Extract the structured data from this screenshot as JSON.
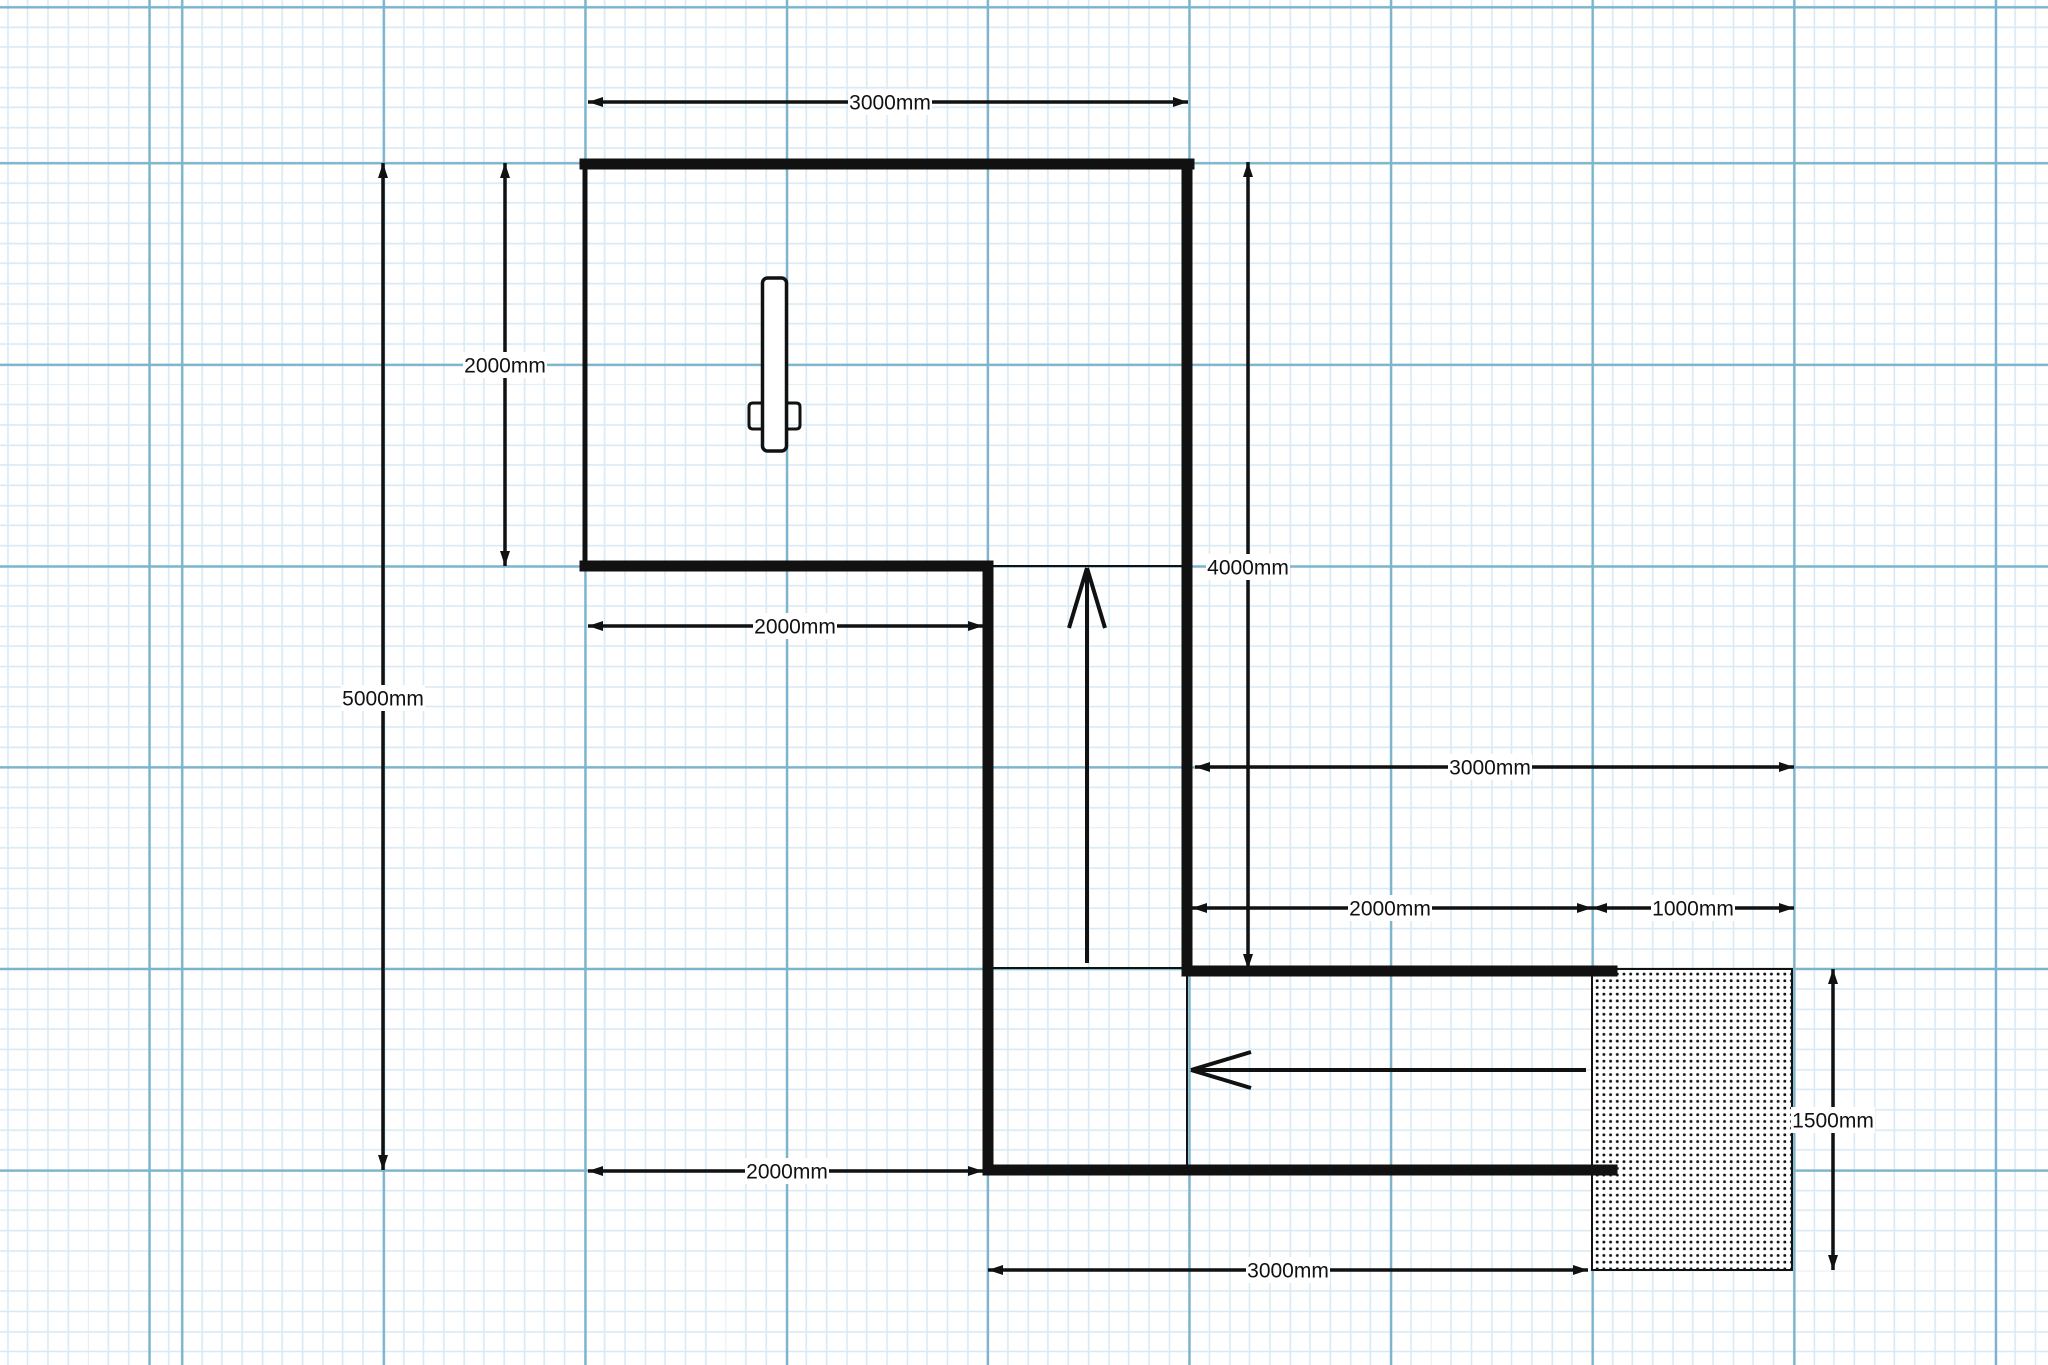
{
  "canvas": {
    "width": 2048,
    "height": 1365,
    "background": "#ffffff"
  },
  "grid": {
    "minor_spacing_px": 20.15,
    "major_spacing_px": 201.5,
    "minor_color": "#d9eaf5",
    "major_color": "#7db4cd",
    "minor_line_px": 1.6,
    "major_line_px": 2.4,
    "offset_x": 182,
    "offset_y": 163,
    "background": "#ffffff"
  },
  "style": {
    "ink_color": "#111111",
    "wall_thick_px": 11,
    "wall_thin_px": 5,
    "inner_line_px": 2,
    "dim_line_px": 3.5,
    "flow_line_px": 4,
    "dim_font_px": 21,
    "label_bg": "#ffffff",
    "label_chip_w": 84,
    "label_chip_h": 26,
    "dim_arrow_len": 15,
    "dim_arrow_half_w": 5,
    "flow_head_back": 60,
    "flow_head_half_w": 18,
    "hatch_dot_spacing": 6.7,
    "hatch_dot_size": 2.8
  },
  "plan": {
    "scale_note": "1000mm = 201.5px",
    "walls_thick": [
      {
        "name": "wall-room-top",
        "x1": 585,
        "y1": 164,
        "x2": 1189,
        "y2": 164
      },
      {
        "name": "wall-room-bottom",
        "x1": 585,
        "y1": 566,
        "x2": 988,
        "y2": 566
      },
      {
        "name": "wall-corridor-left",
        "x1": 988,
        "y1": 566,
        "x2": 988,
        "y2": 1170
      },
      {
        "name": "wall-right",
        "x1": 1187,
        "y1": 164,
        "x2": 1187,
        "y2": 971
      },
      {
        "name": "wall-corridor-top",
        "x1": 1187,
        "y1": 971,
        "x2": 1612,
        "y2": 971
      },
      {
        "name": "wall-corridor-bottom",
        "x1": 988,
        "y1": 1170,
        "x2": 1612,
        "y2": 1170
      }
    ],
    "walls_thin": [
      {
        "name": "wall-room-left",
        "x1": 585,
        "y1": 164,
        "x2": 585,
        "y2": 566
      }
    ],
    "inner_lines": [
      {
        "name": "opening-room-to-corridor",
        "x1": 988,
        "y1": 566,
        "x2": 1187,
        "y2": 566
      },
      {
        "name": "opening-corridor-bend-top",
        "x1": 988,
        "y1": 968,
        "x2": 1187,
        "y2": 968
      },
      {
        "name": "opening-corridor-bend-right",
        "x1": 1187,
        "y1": 976,
        "x2": 1187,
        "y2": 1165
      }
    ],
    "hatch": {
      "name": "hatched-area",
      "x": 1592,
      "y": 969,
      "w": 200,
      "h": 301
    },
    "door": {
      "name": "door-symbol",
      "leaf": {
        "x": 762.5,
        "y": 278,
        "w": 24,
        "h": 173,
        "rx": 5
      },
      "handle_left": "M 764 403 H 753 Q 749 403 749 407 V 425 Q 749 429 753 429 H 764",
      "handle_right": "M 785 403 H 796 Q 800 403 800 407 V 425 Q 800 429 796 429 H 785"
    },
    "dimensions": [
      {
        "name": "dim-top-3000",
        "x1": 588,
        "y1": 102,
        "x2": 1188,
        "y2": 102,
        "label": "3000mm",
        "lx": 890,
        "ly": 102
      },
      {
        "name": "dim-left-5000",
        "x1": 383,
        "y1": 163,
        "x2": 383,
        "y2": 1170,
        "label": "5000mm",
        "lx": 383,
        "ly": 698
      },
      {
        "name": "dim-left-2000",
        "x1": 505,
        "y1": 163,
        "x2": 505,
        "y2": 566,
        "label": "2000mm",
        "lx": 505,
        "ly": 365
      },
      {
        "name": "dim-mid-2000",
        "x1": 588,
        "y1": 626,
        "x2": 983,
        "y2": 626,
        "label": "2000mm",
        "lx": 795,
        "ly": 626
      },
      {
        "name": "dim-right-4000",
        "x1": 1248,
        "y1": 162,
        "x2": 1248,
        "y2": 969,
        "label": "4000mm",
        "lx": 1248,
        "ly": 567
      },
      {
        "name": "dim-right-3000",
        "x1": 1195,
        "y1": 767,
        "x2": 1794,
        "y2": 767,
        "label": "3000mm",
        "lx": 1490,
        "ly": 767
      },
      {
        "name": "dim-right-2000",
        "x1": 1192,
        "y1": 908,
        "x2": 1592,
        "y2": 908,
        "label": "2000mm",
        "lx": 1390,
        "ly": 908
      },
      {
        "name": "dim-right-1000",
        "x1": 1592,
        "y1": 908,
        "x2": 1794,
        "y2": 908,
        "label": "1000mm",
        "lx": 1693,
        "ly": 908
      },
      {
        "name": "dim-bottom-2000",
        "x1": 588,
        "y1": 1171,
        "x2": 983,
        "y2": 1171,
        "label": "2000mm",
        "lx": 787,
        "ly": 1171
      },
      {
        "name": "dim-bottom-3000",
        "x1": 988,
        "y1": 1270,
        "x2": 1588,
        "y2": 1270,
        "label": "3000mm",
        "lx": 1288,
        "ly": 1270
      },
      {
        "name": "dim-right-1500",
        "x1": 1833,
        "y1": 969,
        "x2": 1833,
        "y2": 1270,
        "label": "1500mm",
        "lx": 1833,
        "ly": 1120
      }
    ],
    "flow_arrows": [
      {
        "name": "flow-arrow-up",
        "x1": 1087,
        "y1": 963,
        "x2": 1087,
        "y2": 568
      },
      {
        "name": "flow-arrow-left",
        "x1": 1586,
        "y1": 1070,
        "x2": 1191,
        "y2": 1070
      }
    ]
  }
}
